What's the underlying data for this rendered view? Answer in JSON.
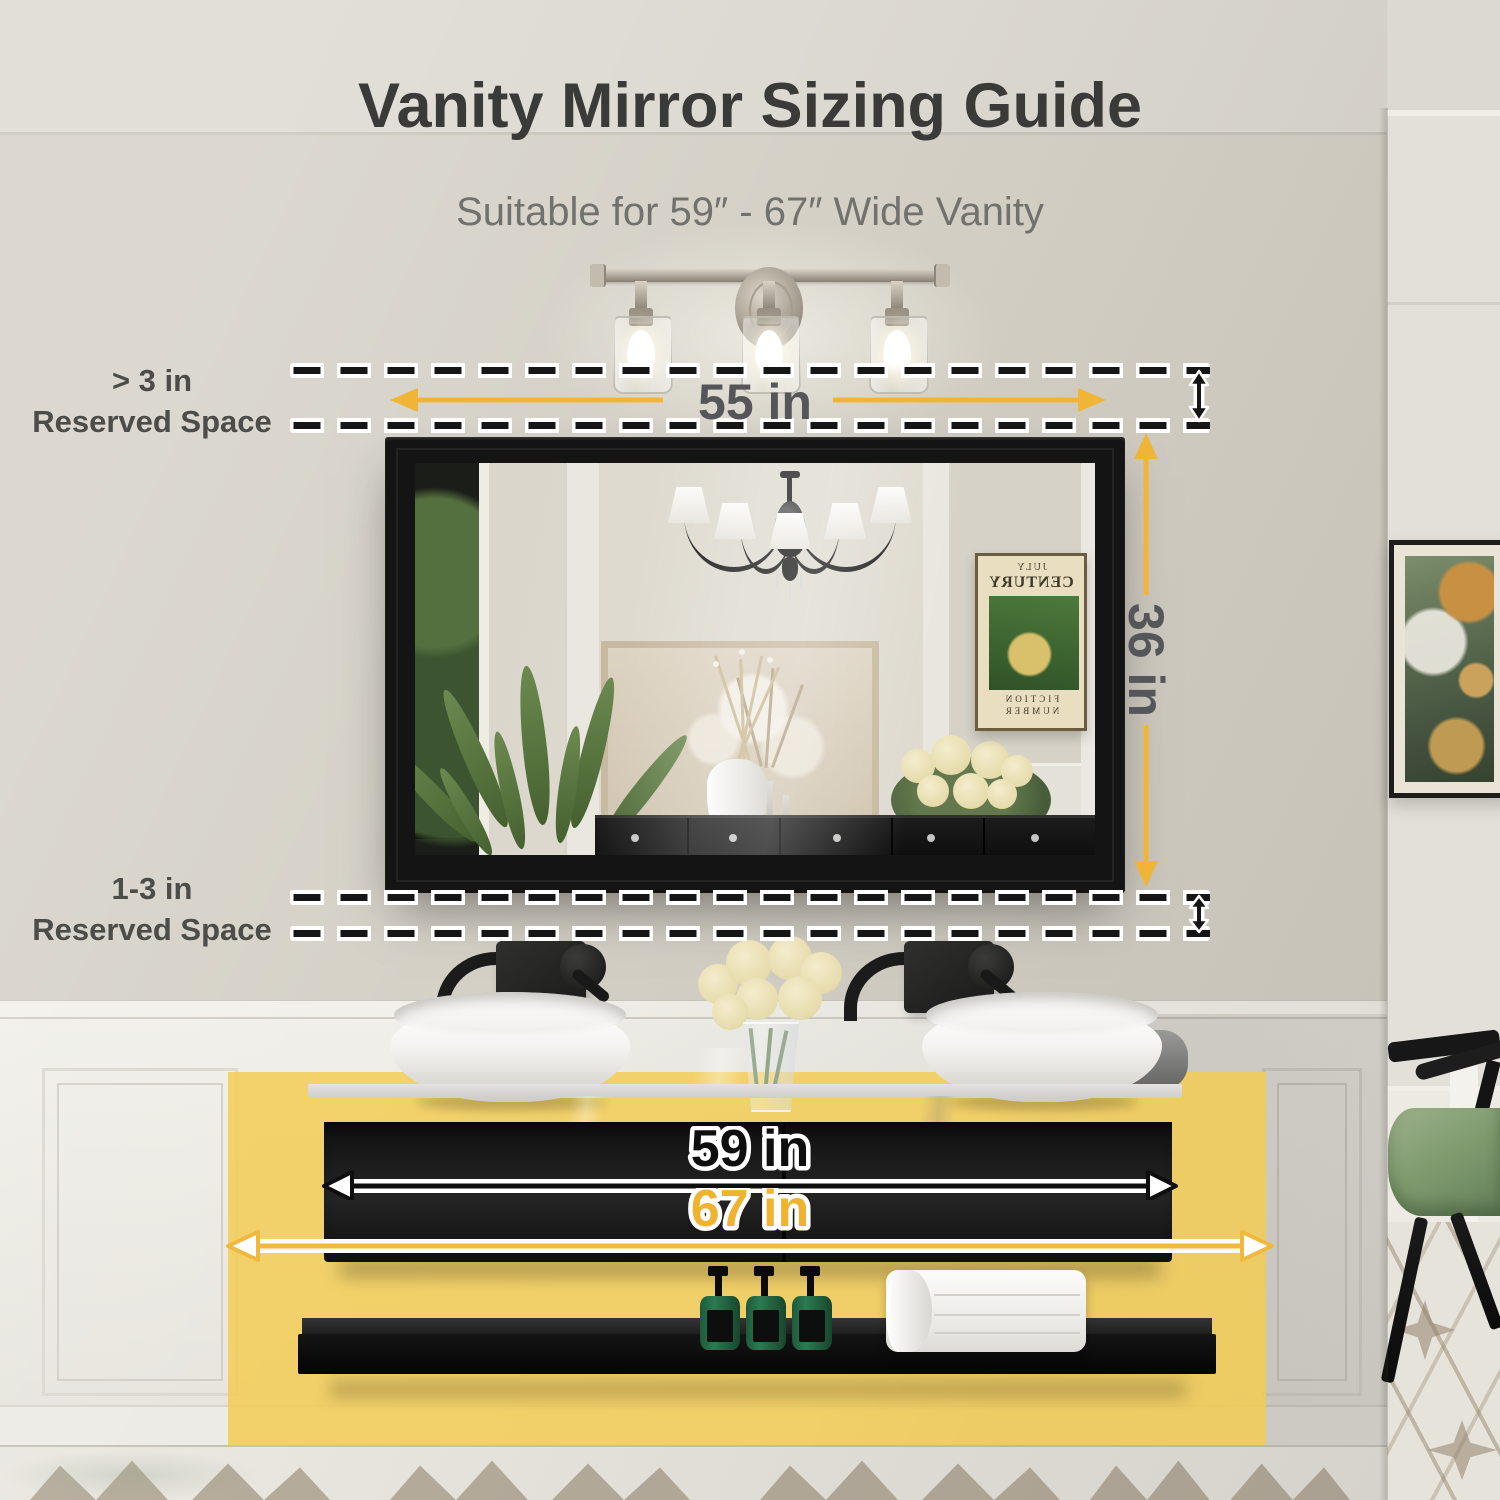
{
  "title": "Vanity Mirror Sizing Guide",
  "subtitle": "Suitable for 59″ - 67″ Wide Vanity",
  "dimensions": {
    "mirror_width": "55 in",
    "mirror_height": "36 in",
    "vanity_width_min": "59 in",
    "vanity_width_max": "67 in"
  },
  "reserved_space": {
    "top_line1": "> 3 in",
    "top_line2": "Reserved Space",
    "bottom_line1": "1-3 in",
    "bottom_line2": "Reserved Space"
  },
  "reflection_poster": {
    "line1": "JULY",
    "line2": "CENTURY",
    "line3": "FICTION",
    "line4": "NUMBER"
  },
  "colors": {
    "accent_yellow_arrow": "#F0B537",
    "highlight_zone_yellow": "#F3CD55",
    "dimension_black": "#111111",
    "label_gray": "#55565A",
    "wall_greige": "#D5D1C7"
  }
}
